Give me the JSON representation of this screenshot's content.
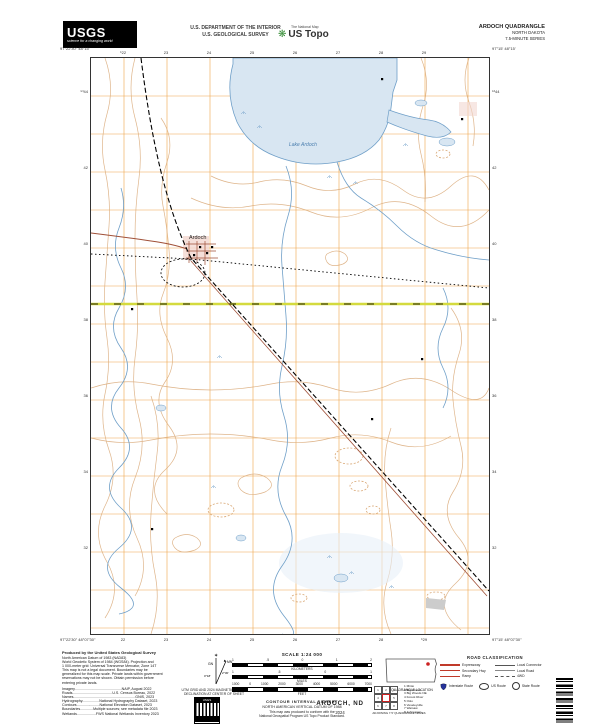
{
  "colors": {
    "grid_orange": "#EFA54A",
    "contour_tan": "#D9A876",
    "water_fill": "#D8E6F2",
    "water_line": "#6F9FC8",
    "veg_green": "#D5E8C0",
    "road_red": "#A05038",
    "highway_yellow": "#D4DA3E",
    "interstate_blue": "#26339B",
    "legend_red": "#C03A2A"
  },
  "header": {
    "usgs_logo_text": "USGS",
    "usgs_tagline": "science for a changing world",
    "dept_line1": "U.S. DEPARTMENT OF THE INTERIOR",
    "dept_line2": "U.S. GEOLOGICAL SURVEY",
    "ustopo_small": "The National Map",
    "ustopo_name": "US Topo",
    "quad_title": "ARDOCH QUADRANGLE",
    "quad_state": "NORTH DAKOTA",
    "quad_series": "7.5-MINUTE SERIES"
  },
  "map": {
    "labels": {
      "town": "Ardoch",
      "lake": "Lake Ardoch"
    },
    "corners": {
      "tl_lon": "97°22'30\"",
      "tl_lat": "48°15'",
      "tr_lon": "97°15'",
      "tr_lat": "48°15'",
      "bl_lon": "97°22'30\"",
      "bl_lat": "48°07'30\"",
      "br_lon": "97°15'",
      "br_lat": "48°07'30\""
    },
    "top_labels": [
      "⁶22",
      "23",
      "24",
      "25",
      "26",
      "27",
      "28",
      "29"
    ],
    "bottom_labels": [
      "22",
      "23",
      "24",
      "25",
      "26",
      "27",
      "28",
      "⁶29"
    ],
    "side_labels": [
      "⁵³44",
      "42",
      "40",
      "38",
      "36",
      "34",
      "32"
    ]
  },
  "footer": {
    "credits": {
      "title": "Produced by the United States Geological Survey",
      "lines": [
        "North American Datum of 1983 (NAD83)",
        "World Geodetic System of 1984 (WGS84).  Projection and",
        "1 000-meter grid: Universal Transverse Mercator, Zone 14T",
        "This map is not a legal document. Boundaries may be",
        "generalized for this map scale. Private lands within government",
        "reservations may not be shown. Obtain permission before",
        "entering private lands.",
        "Imagery...............................................NAIP, August 2022",
        "Roads........................................U.S. Census Bureau, 2022",
        "Names..............................................................GNIS, 2023",
        "Hydrography.................National Hydrography Dataset, 2023",
        "Contours.......................National Elevation Dataset, 2023",
        "Boundaries.............Multiple sources; see metadata file 2023",
        "Wetlands...................FWS National Wetlands Inventory 2023"
      ]
    },
    "declination": {
      "star": "✶",
      "gn_label": "GN",
      "mn_label": "MN",
      "gn_value": "0°18'",
      "mn_value": "2°30'",
      "caption1": "UTM GRID AND 2024 MAGNETIC NORTH",
      "caption2": "DECLINATION AT CENTER OF SHEET"
    },
    "scale": {
      "title": "SCALE 1:24 000",
      "bars": [
        {
          "unit": "KILOMETERS",
          "ticks": [
            "1",
            ".5",
            "0",
            "1",
            "2"
          ]
        },
        {
          "unit": "MILES",
          "ticks": [
            "1",
            ".5",
            "0",
            "1"
          ]
        },
        {
          "unit": "FEET",
          "ticks": [
            "1000",
            "0",
            "1000",
            "2000",
            "3000",
            "4000",
            "5000",
            "6000",
            "7000"
          ]
        }
      ],
      "contour1": "CONTOUR INTERVAL 10 FEET",
      "contour2": "NORTH AMERICAN VERTICAL DATUM OF 1988",
      "standard1": "This map was produced to conform with the",
      "standard2": "National Geospatial Program US Topo Product Standard."
    },
    "locator": {
      "caption": "QUADRANGLE LOCATION"
    },
    "roads": {
      "title": "ROAD CLASSIFICATION",
      "col1": [
        "Expressway",
        "Secondary Hwy",
        "Ramp"
      ],
      "col2": [
        "Local Connector",
        "Local Road",
        "4WD"
      ],
      "shields": [
        "Interstate Route",
        "US Route",
        "State Route"
      ]
    },
    "adjoining": {
      "grid_numbers": [
        "1",
        "2",
        "3",
        "4",
        "5",
        "6",
        "7",
        "8"
      ],
      "names": [
        "1  Minto",
        "2  Big Woods",
        "3  Big Woods NE",
        "4  Forest River",
        "5  Oslo",
        "6  Veseleyville",
        "7  Warsaw",
        "8  Johnstown"
      ],
      "caption": "ADJOINING 7.5' QUADRANGLE NAMES"
    },
    "title_block": {
      "name": "ARDOCH, ND",
      "year": "2024"
    }
  }
}
